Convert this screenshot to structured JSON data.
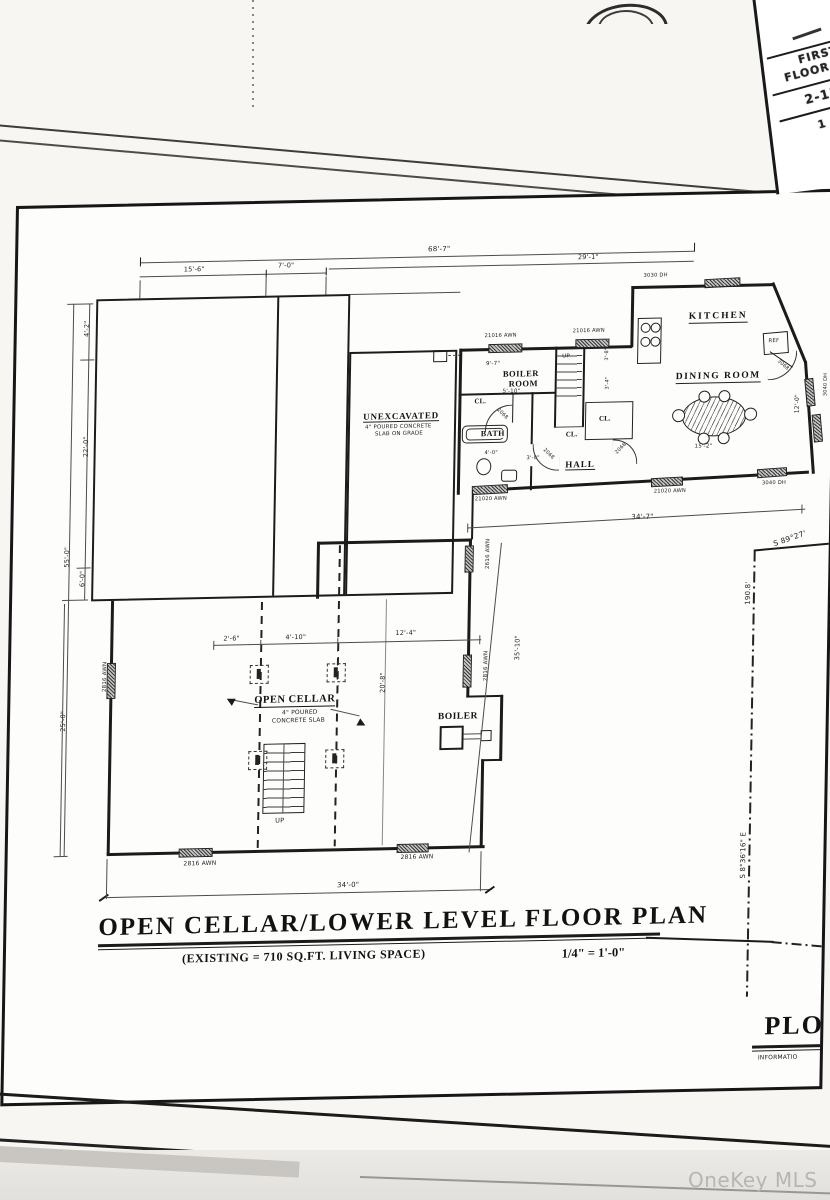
{
  "photo": {
    "watermark": "OneKey MLS"
  },
  "other_sheet": {
    "line1": "FIRST",
    "line2": "FLOOR P",
    "line3": "2-13",
    "line4": "1 O"
  },
  "titleblock": {
    "title": "OPEN CELLAR/LOWER LEVEL FLOOR PLAN",
    "subtitle": "(EXISTING = 710 SQ.FT. LIVING SPACE)",
    "scale": "1/4\" = 1'-0\"",
    "corner_title": "PLO",
    "corner_subtitle": "INFORMATIO"
  },
  "rooms": {
    "kitchen": "KITCHEN",
    "dining": "DINING ROOM",
    "boiler_room1": "BOILER",
    "boiler_room2": "ROOM",
    "bath": "BATH",
    "hall": "HALL",
    "closet": "CL.",
    "unexcavated": "UNEXCAVATED",
    "unexcavated_note1": "4\" POURED CONCRETE",
    "unexcavated_note2": "SLAB ON GRADE",
    "open_cellar": "OPEN CELLAR",
    "open_cellar_note1": "4\" POURED",
    "open_cellar_note2": "CONCRETE SLAB",
    "boiler": "BOILER",
    "ref": "REF",
    "up": "UP"
  },
  "dims": {
    "d68_7": "68'-7\"",
    "d29_1": "29'-1\"",
    "d15_6": "15'-6\"",
    "d7_0": "7'-0\"",
    "d4_2": "4'-2\"",
    "d22_0": "22'-0\"",
    "d55_0": "55'-0\"",
    "d6_0": "6'-0\"",
    "d25_0": "25'-0\"",
    "d9_7": "9'-7\"",
    "d5_10": "5'-10\"",
    "d4_0": "4'-0\"",
    "d3_0": "3'-0\"",
    "d3_8": "3'-8\"",
    "d3_4": "3'-4\"",
    "d34_7": "34'-7\"",
    "d2_6": "2'-6\"",
    "d4_10": "4'-10\"",
    "d12_4": "12'-4\"",
    "d20_8": "20'-8\"",
    "d35_10": "35'-10\"",
    "d34_0": "34'-0\"",
    "d12_0": "12'-0\"",
    "d15_2": "15'-2\""
  },
  "windows": {
    "w3030": "3030 DH",
    "w21016": "21016 AWN",
    "w21020": "21020 AWN",
    "w3040": "3040 DH",
    "w3040f": "3040 FIXED",
    "w2816": "2816 AWN",
    "w2616": "2616 AWN"
  },
  "doors": {
    "d3068": "3068",
    "d2068": "2068"
  },
  "site": {
    "bearing_top": "S 89°27'",
    "length": "190.8'",
    "bearing_side": "S 8°36'16\" E"
  }
}
